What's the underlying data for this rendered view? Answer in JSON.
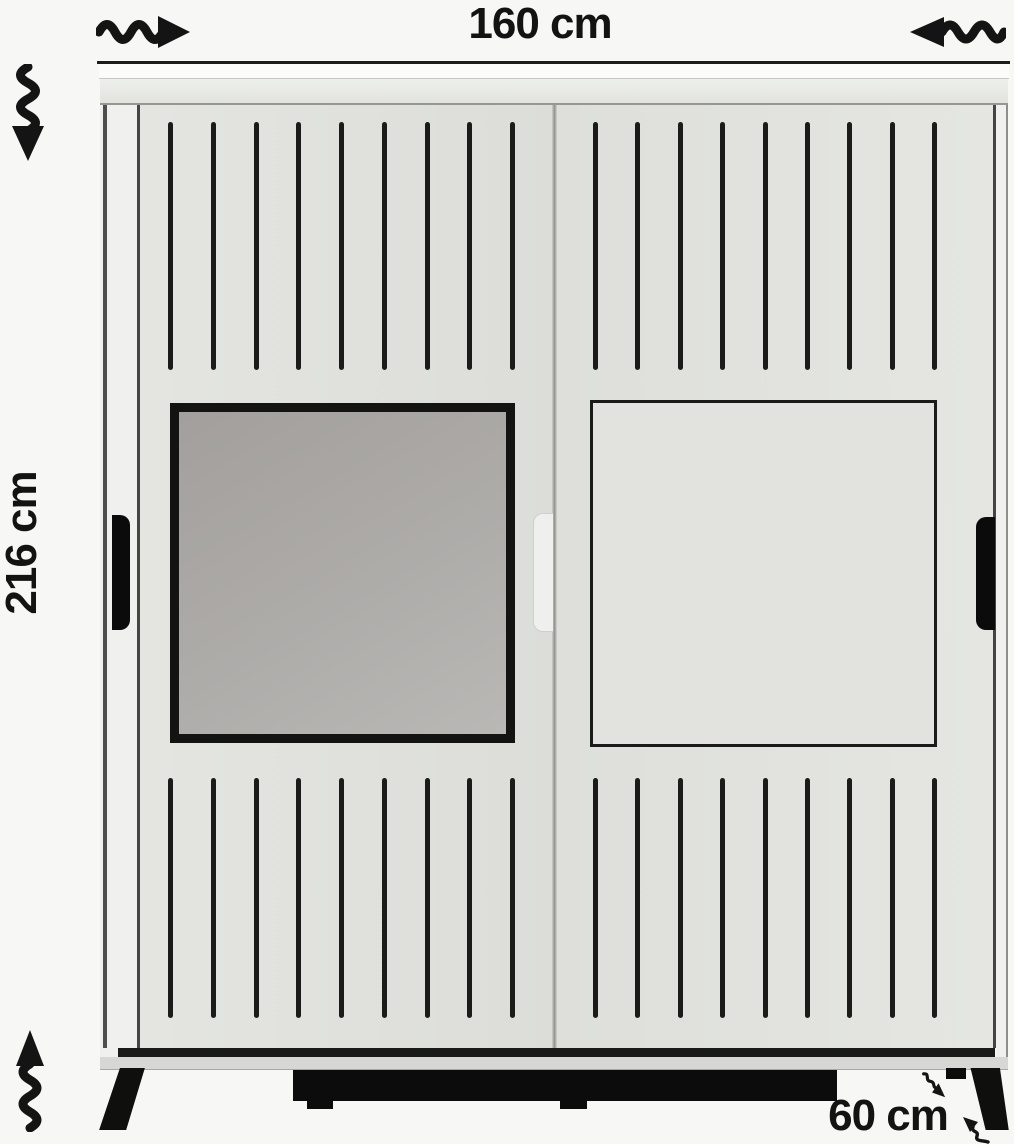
{
  "dimensions": {
    "width": "160 cm",
    "height": "216 cm",
    "depth": "60 cm"
  },
  "figure": {
    "type": "wardrobe-dimension-diagram",
    "product": "two-door sliding wardrobe with mirror",
    "slats_per_row": 9,
    "icons": {
      "width_arrow_right": "wavy-arrow-right",
      "width_arrow_left": "wavy-arrow-left",
      "height_arrow_down": "wavy-arrow-down",
      "height_arrow_up": "wavy-arrow-up",
      "depth_arrow_down_right": "small-wavy-arrow-down-right",
      "depth_arrow_up_left": "small-wavy-arrow-up-left"
    },
    "colors": {
      "background": "#f7f7f5",
      "annotation": "#141414",
      "door_face": "#e0e1dd",
      "header": "#e8e9e5",
      "mirror": "#aba8a5",
      "slats": "#1b1b19",
      "plinth_and_legs": "#0d0d0d"
    }
  }
}
